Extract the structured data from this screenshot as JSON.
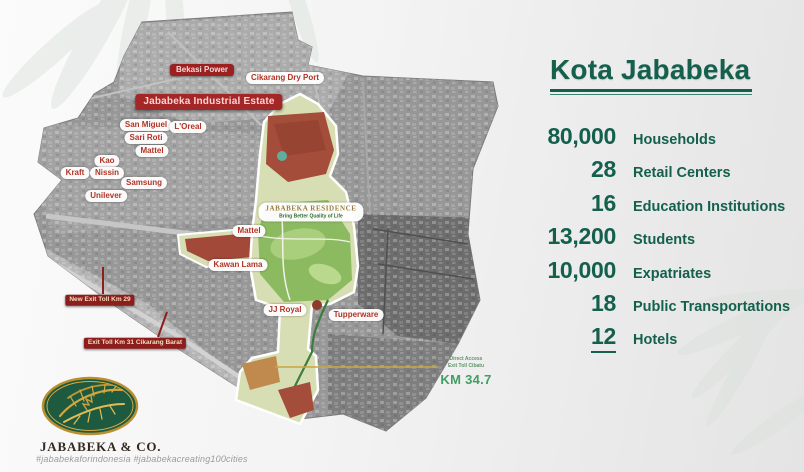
{
  "panel": {
    "title": "Kota Jababeka",
    "stats": [
      {
        "value": "80,000",
        "label": "Households"
      },
      {
        "value": "28",
        "label": "Retail Centers"
      },
      {
        "value": "16",
        "label": "Education Institutions"
      },
      {
        "value": "13,200",
        "label": "Students"
      },
      {
        "value": "10,000",
        "label": "Expatriates"
      },
      {
        "value": "18",
        "label": "Public Transportations"
      },
      {
        "value": "12",
        "label": "Hotels"
      }
    ]
  },
  "map": {
    "estate_label": "Jababeka Industrial Estate",
    "company_labels": {
      "bekasi_power": "Bekasi Power",
      "cikarang_dry_port": "Cikarang Dry Port",
      "san_miguel": "San Miguel",
      "loreal": "L'Oreal",
      "sari_roti": "Sari Roti",
      "mattel_north": "Mattel",
      "kao": "Kao",
      "kraft": "Kraft",
      "nissin": "Nissin",
      "samsung": "Samsung",
      "unilever": "Unilever",
      "mattel_central": "Mattel",
      "kawan_lama": "Kawan Lama",
      "jj_royal": "JJ Royal",
      "tupperware": "Tupperware"
    },
    "residence": {
      "name": "JABABEKA RESIDENCE",
      "tagline": "Bring Better Quality of Life"
    },
    "toll_labels": {
      "new_exit_toll": "New Exit Toll Km 29",
      "exit_toll_31": "Exit Toll Km 31 Cikarang Barat"
    },
    "toll_access": {
      "caption_line1": "Direct Access",
      "caption_line2": "Exit Toll Cibatu",
      "distance": "KM 34.7"
    }
  },
  "footer": {
    "brand": "JABABEKA & CO.",
    "hashtags": "#jababekaforindonesia #jababekacreating100cities"
  },
  "colors": {
    "accent_green": "#14604D",
    "badge_red": "#9C2020",
    "label_red": "#B23325",
    "km_green": "#3FA065",
    "logo_green": "#1D5A40",
    "logo_gold": "#D4A63C"
  }
}
